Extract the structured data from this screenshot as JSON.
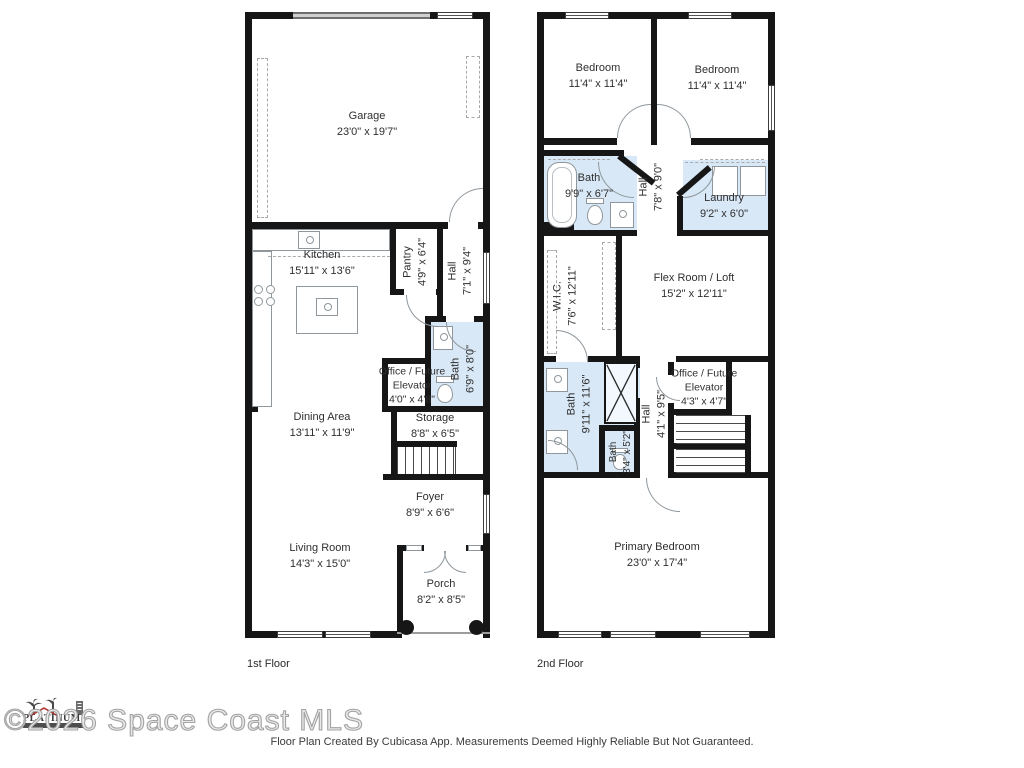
{
  "watermark": {
    "logo_text": "PLATINUM",
    "copyright": "©2026 Space Coast MLS"
  },
  "footer": {
    "disclaimer": "Floor Plan Created By Cubicasa App. Measurements Deemed Highly Reliable But Not Guaranteed."
  },
  "colors": {
    "wall": "#161616",
    "wet_room_fill": "#d9e8f6",
    "fixture_line": "#8f979c",
    "label_text": "#2f2f2f",
    "watermark": "#a3a3a3"
  },
  "floors": [
    {
      "label": "1st Floor",
      "rooms": [
        {
          "name": "Garage",
          "dims": "23'0\" x 19'7\""
        },
        {
          "name": "Kitchen",
          "dims": "15'11\" x 13'6\""
        },
        {
          "name": "Pantry",
          "dims": "4'9\" x 6'4\""
        },
        {
          "name": "Hall",
          "dims": "7'1\" x 9'4\""
        },
        {
          "name": "Bath",
          "dims": "6'9\" x 8'0\""
        },
        {
          "name": "Office / Future Elevator",
          "dims": "4'0\" x 4'8\""
        },
        {
          "name": "Dining Area",
          "dims": "13'11\" x 11'9\""
        },
        {
          "name": "Storage",
          "dims": "8'8\" x 6'5\""
        },
        {
          "name": "Foyer",
          "dims": "8'9\" x 6'6\""
        },
        {
          "name": "Living Room",
          "dims": "14'3\" x 15'0\""
        },
        {
          "name": "Porch",
          "dims": "8'2\" x 8'5\""
        }
      ]
    },
    {
      "label": "2nd Floor",
      "rooms": [
        {
          "name": "Bedroom",
          "dims": "11'4\" x 11'4\""
        },
        {
          "name": "Bedroom",
          "dims": "11'4\" x 11'4\""
        },
        {
          "name": "Bath",
          "dims": "9'9\" x 6'7\""
        },
        {
          "name": "Hall",
          "dims": "7'8\" x 9'0\""
        },
        {
          "name": "Laundry",
          "dims": "9'2\" x 6'0\""
        },
        {
          "name": "W.I.C.",
          "dims": "7'6\" x 12'11\""
        },
        {
          "name": "Flex Room / Loft",
          "dims": "15'2\" x 12'11\""
        },
        {
          "name": "Bath",
          "dims": "9'11\" x 11'6\""
        },
        {
          "name": "Bath",
          "dims": "3'4\" x 5'2\""
        },
        {
          "name": "Hall",
          "dims": "4'1\" x 9'5\""
        },
        {
          "name": "Office / Future Elevator",
          "dims": "4'3\" x 4'7\""
        },
        {
          "name": "Primary Bedroom",
          "dims": "23'0\" x 17'4\""
        }
      ]
    }
  ]
}
